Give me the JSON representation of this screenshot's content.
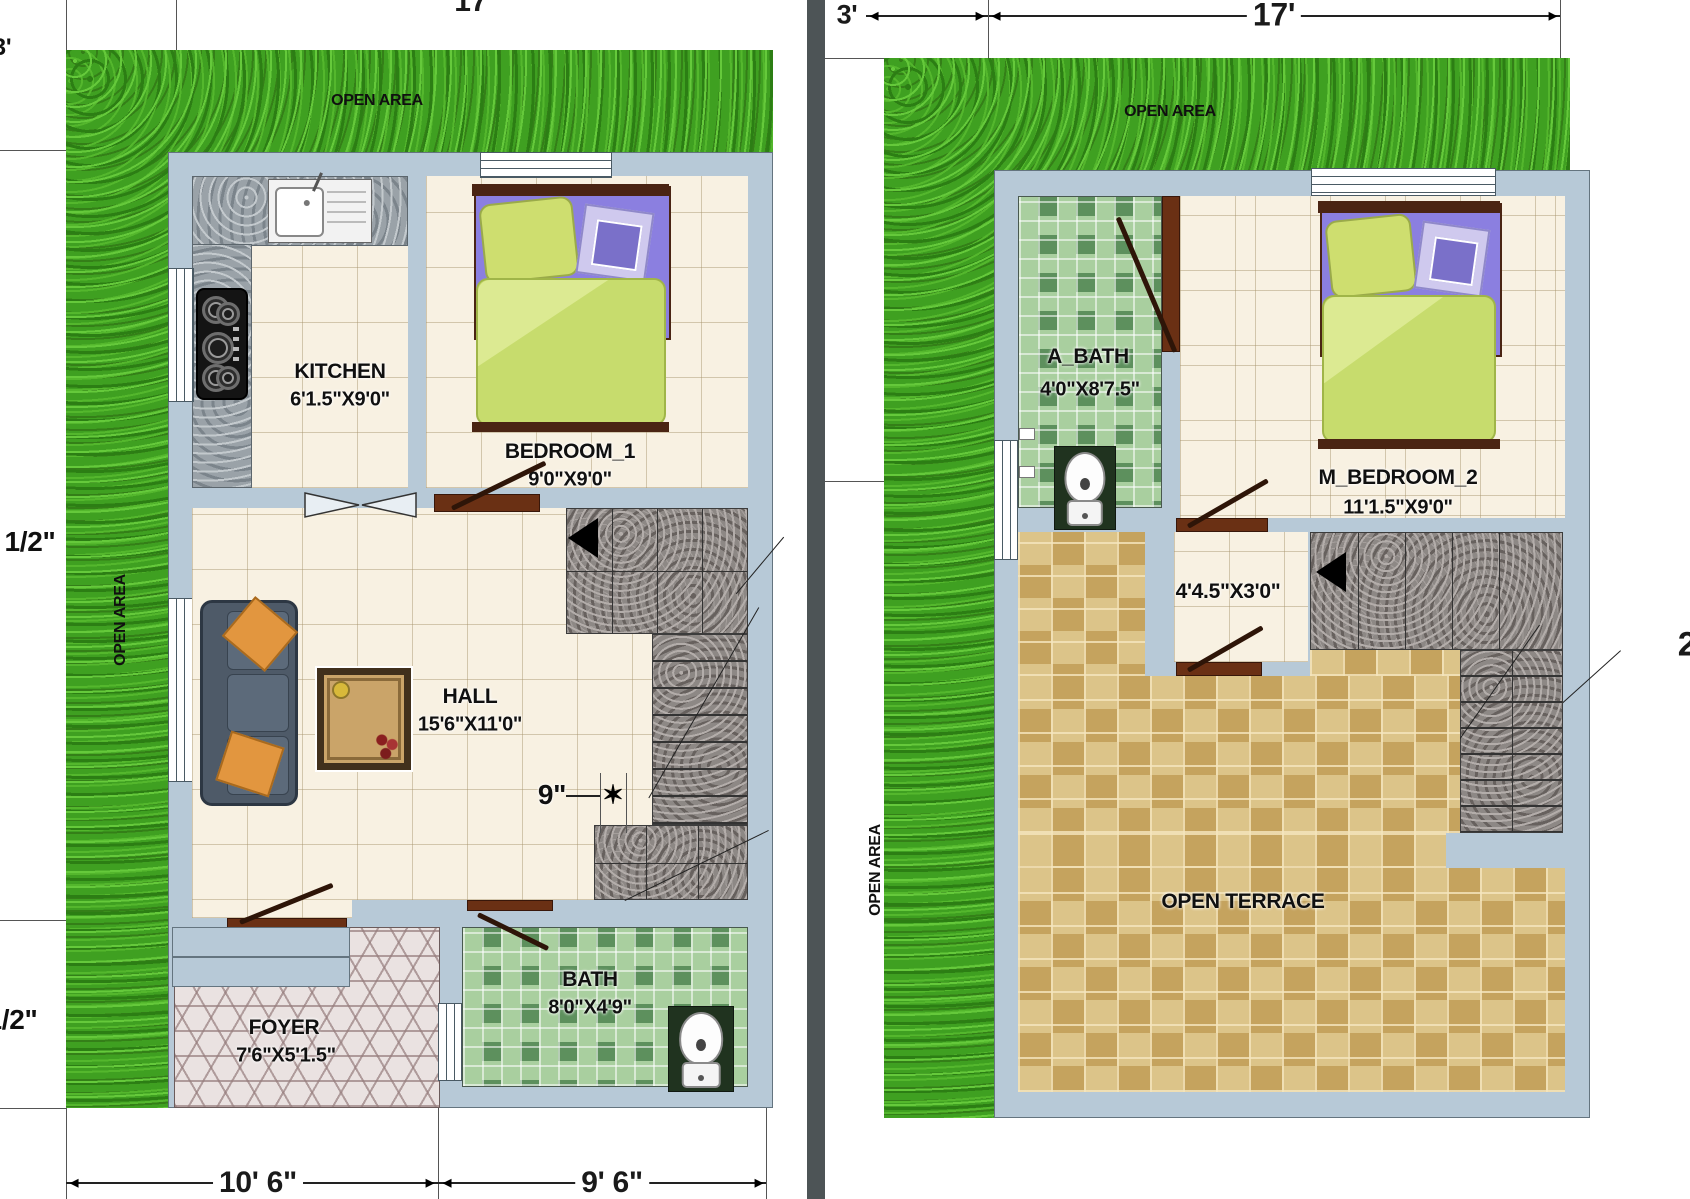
{
  "left_plan": {
    "open_area_top": "OPEN AREA",
    "open_area_side": "OPEN AREA",
    "kitchen": {
      "name": "KITCHEN",
      "size": "6'1.5\"X9'0\""
    },
    "bedroom1": {
      "name": "BEDROOM_1",
      "size": "9'0\"X9'0\""
    },
    "hall": {
      "name": "HALL",
      "size": "15'6\"X11'0\""
    },
    "foyer": {
      "name": "FOYER",
      "size": "7'6\"X5'1.5\""
    },
    "bath": {
      "name": "BATH",
      "size": "8'0\"X4'9\""
    },
    "dimensions": {
      "top_width": "17'",
      "setback_left": "3'",
      "side_upper": "1/2\"",
      "side_lower": "1/2\"",
      "bottom_left": "10' 6\"",
      "bottom_right": "9' 6\"",
      "stair_offset": "9\""
    }
  },
  "right_plan": {
    "open_area_top": "OPEN AREA",
    "open_area_side": "OPEN AREA",
    "a_bath": {
      "name": "A_BATH",
      "size": "4'0\"X8'7.5\""
    },
    "m_bedroom2": {
      "name": "M_BEDROOM_2",
      "size": "11'1.5\"X9'0\""
    },
    "landing": {
      "size": "4'4.5\"X3'0\""
    },
    "open_terrace": "OPEN TERRACE",
    "dimensions": {
      "setback_left": "3'",
      "top_width": "17'",
      "side_right_partial": "2"
    }
  },
  "colors": {
    "wall": "#b7c9d7",
    "grass": "#3fa021",
    "floor_tile": "#f8f1e2",
    "terrace_tile": "#d3b87b",
    "bath_tile": "#a9cf9f",
    "granite_stairs": "#8d8885",
    "divider_bar": "#4d5456",
    "door": "#6a3014"
  }
}
